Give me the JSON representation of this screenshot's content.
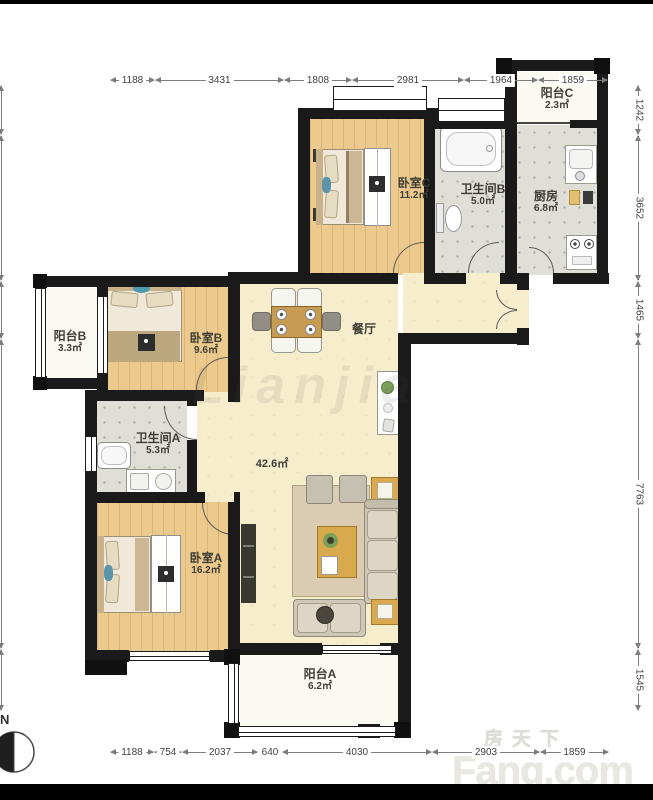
{
  "page": {
    "type": "apartment-floor-plan"
  },
  "watermarks": {
    "center": "Lianjia",
    "site_cn": "房天下",
    "site_en": "Fang.com"
  },
  "compass": {
    "label": "N"
  },
  "dimensions": {
    "top": [
      "1188",
      "3431",
      "1808",
      "2981",
      "1964",
      "1859"
    ],
    "bottom": [
      "1188",
      "754",
      "2037",
      "640",
      "4030",
      "2903",
      "1859"
    ],
    "right": [
      "1242",
      "3652",
      "1465",
      "7763",
      "1545"
    ],
    "left": {
      "cut_off": true,
      "values_visible": false
    }
  },
  "rooms": [
    {
      "name": "阳台C",
      "area": "2.3㎡"
    },
    {
      "name": "厨房",
      "area": "6.8㎡"
    },
    {
      "name": "卧室C",
      "area": "11.2㎡"
    },
    {
      "name": "卫生间B",
      "area": "5.0㎡"
    },
    {
      "name": "阳台B",
      "area": "3.3㎡"
    },
    {
      "name": "卧室B",
      "area": "9.6㎡"
    },
    {
      "name": "餐厅",
      "area": ""
    },
    {
      "name": "",
      "area": "42.6㎡"
    },
    {
      "name": "卫生间A",
      "area": "5.3㎡"
    },
    {
      "name": "卧室A",
      "area": "16.2㎡"
    },
    {
      "name": "阳台A",
      "area": "6.2㎡"
    }
  ],
  "colors": {
    "wall": "#1a1a1a",
    "wood_floor": "#ecc98c",
    "tile_floor": "#dfdfd8",
    "living_floor": "#f6edcd",
    "balcony_floor": "#fbfaf2",
    "furniture_wood": "#c89b52"
  }
}
